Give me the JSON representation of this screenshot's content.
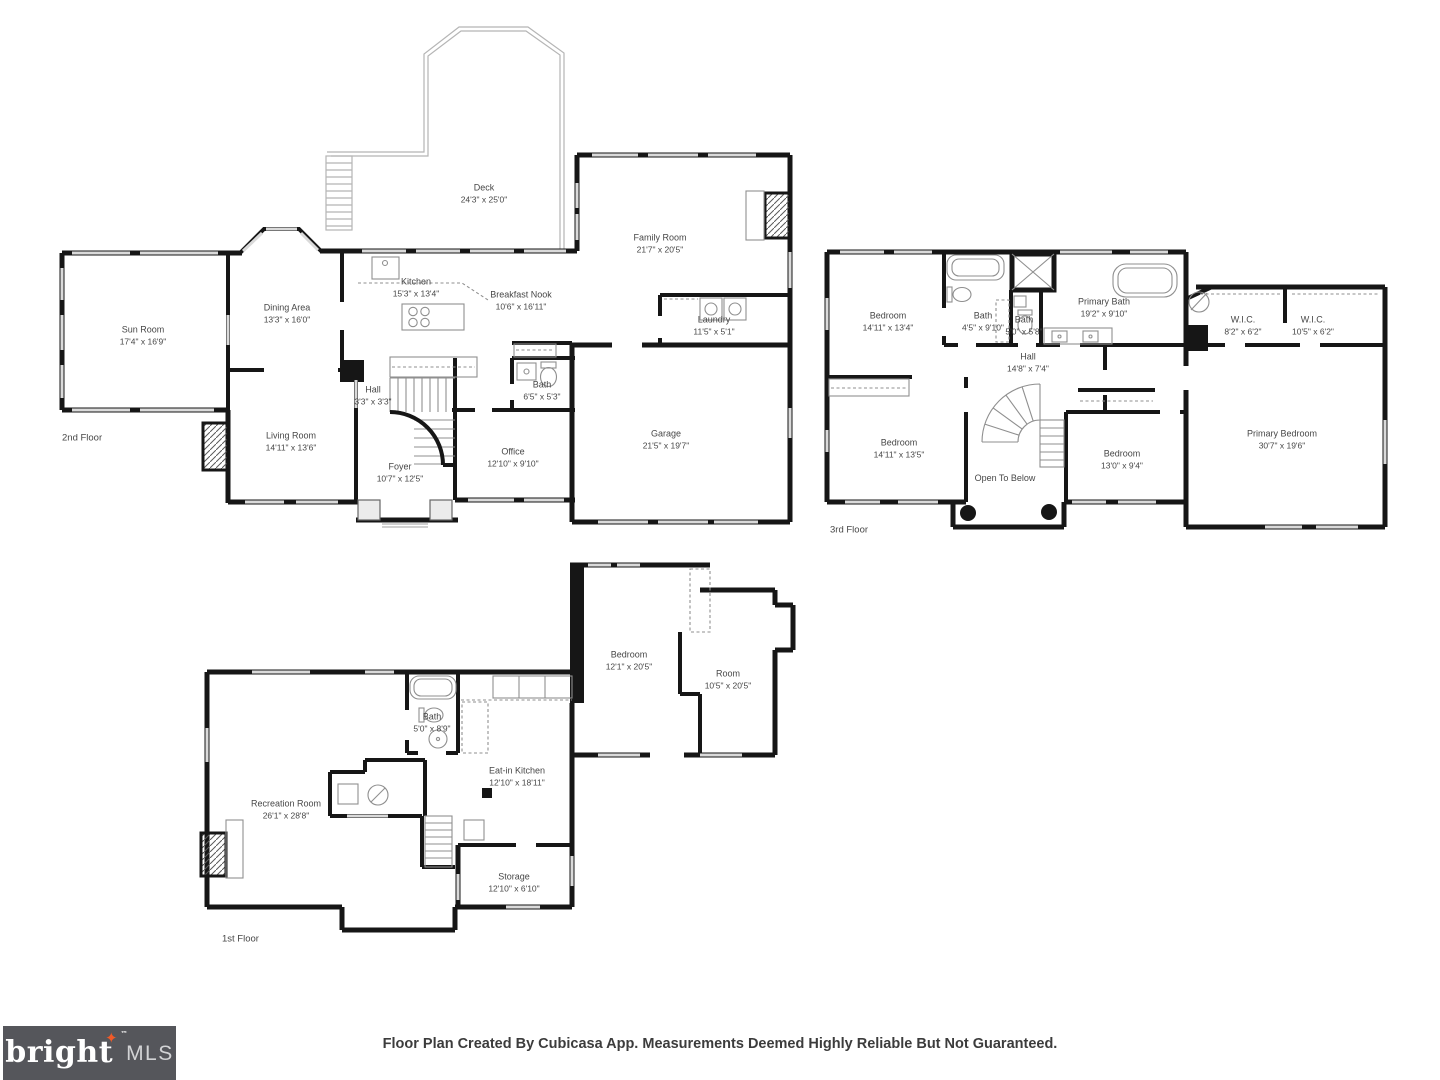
{
  "canvas": {
    "width": 1440,
    "height": 1080,
    "background": "#ffffff",
    "wall_color": "#161616",
    "window_color": "#dadada"
  },
  "footer": {
    "disclaimer": "Floor Plan Created By Cubicasa App. Measurements Deemed Highly Reliable But Not Guaranteed.",
    "logo": {
      "brand": "bright",
      "tm": "™",
      "suffix": "MLS",
      "star": "✦",
      "background": "#55565b",
      "brand_color": "#ffffff",
      "suffix_color": "#d2d3d5",
      "star_color": "#f05a28"
    }
  },
  "floors": [
    {
      "id": "second-floor",
      "caption": "2nd Floor",
      "caption_x": 62,
      "caption_y": 438,
      "rooms": [
        {
          "name": "Sun Room",
          "dims": "17'4\" x 16'9\"",
          "x": 143,
          "y": 336
        },
        {
          "name": "Dining Area",
          "dims": "13'3\" x 16'0\"",
          "x": 287,
          "y": 314
        },
        {
          "name": "Kitchen",
          "dims": "15'3\" x 13'4\"",
          "x": 416,
          "y": 288
        },
        {
          "name": "Deck",
          "dims": "24'3\" x 25'0\"",
          "x": 484,
          "y": 194
        },
        {
          "name": "Breakfast Nook",
          "dims": "10'6\" x 16'11\"",
          "x": 521,
          "y": 301
        },
        {
          "name": "Family Room",
          "dims": "21'7\" x 20'5\"",
          "x": 660,
          "y": 244
        },
        {
          "name": "Laundry",
          "dims": "11'5\" x 5'1\"",
          "x": 714,
          "y": 326
        },
        {
          "name": "Hall",
          "dims": "3'3\" x 3'3\"",
          "x": 373,
          "y": 396
        },
        {
          "name": "Bath",
          "dims": "6'5\" x 5'3\"",
          "x": 542,
          "y": 391
        },
        {
          "name": "Living Room",
          "dims": "14'11\" x 13'6\"",
          "x": 291,
          "y": 442
        },
        {
          "name": "Foyer",
          "dims": "10'7\" x 12'5\"",
          "x": 400,
          "y": 473
        },
        {
          "name": "Office",
          "dims": "12'10\" x 9'10\"",
          "x": 513,
          "y": 458
        },
        {
          "name": "Garage",
          "dims": "21'5\" x 19'7\"",
          "x": 666,
          "y": 440
        }
      ]
    },
    {
      "id": "third-floor",
      "caption": "3rd Floor",
      "caption_x": 830,
      "caption_y": 530,
      "rooms": [
        {
          "name": "Bedroom",
          "dims": "14'11\" x 13'4\"",
          "x": 888,
          "y": 322
        },
        {
          "name": "Bath",
          "dims": "4'5\" x 9'10\"",
          "x": 983,
          "y": 322
        },
        {
          "name": "Bath",
          "dims": "5'0\" x 5'8\"",
          "x": 1024,
          "y": 326
        },
        {
          "name": "Primary Bath",
          "dims": "19'2\" x 9'10\"",
          "x": 1104,
          "y": 308
        },
        {
          "name": "W.I.C.",
          "dims": "8'2\" x 6'2\"",
          "x": 1243,
          "y": 326
        },
        {
          "name": "W.I.C.",
          "dims": "10'5\" x 6'2\"",
          "x": 1313,
          "y": 326
        },
        {
          "name": "Hall",
          "dims": "14'8\" x 7'4\"",
          "x": 1028,
          "y": 363
        },
        {
          "name": "Bedroom",
          "dims": "14'11\" x 13'5\"",
          "x": 899,
          "y": 449
        },
        {
          "name": "Open To Below",
          "dims": "",
          "x": 1005,
          "y": 479
        },
        {
          "name": "Bedroom",
          "dims": "13'0\" x 9'4\"",
          "x": 1122,
          "y": 460
        },
        {
          "name": "Primary Bedroom",
          "dims": "30'7\" x 19'6\"",
          "x": 1282,
          "y": 440
        }
      ]
    },
    {
      "id": "first-floor",
      "caption": "1st Floor",
      "caption_x": 222,
      "caption_y": 939,
      "rooms": [
        {
          "name": "Bath",
          "dims": "5'0\" x 8'9\"",
          "x": 432,
          "y": 723
        },
        {
          "name": "Bedroom",
          "dims": "12'1\" x 20'5\"",
          "x": 629,
          "y": 661
        },
        {
          "name": "Room",
          "dims": "10'5\" x 20'5\"",
          "x": 728,
          "y": 680
        },
        {
          "name": "Eat-in Kitchen",
          "dims": "12'10\" x 18'11\"",
          "x": 517,
          "y": 777
        },
        {
          "name": "Recreation Room",
          "dims": "26'1\" x 28'8\"",
          "x": 286,
          "y": 810
        },
        {
          "name": "Storage",
          "dims": "12'10\" x 6'10\"",
          "x": 514,
          "y": 883
        }
      ]
    }
  ]
}
